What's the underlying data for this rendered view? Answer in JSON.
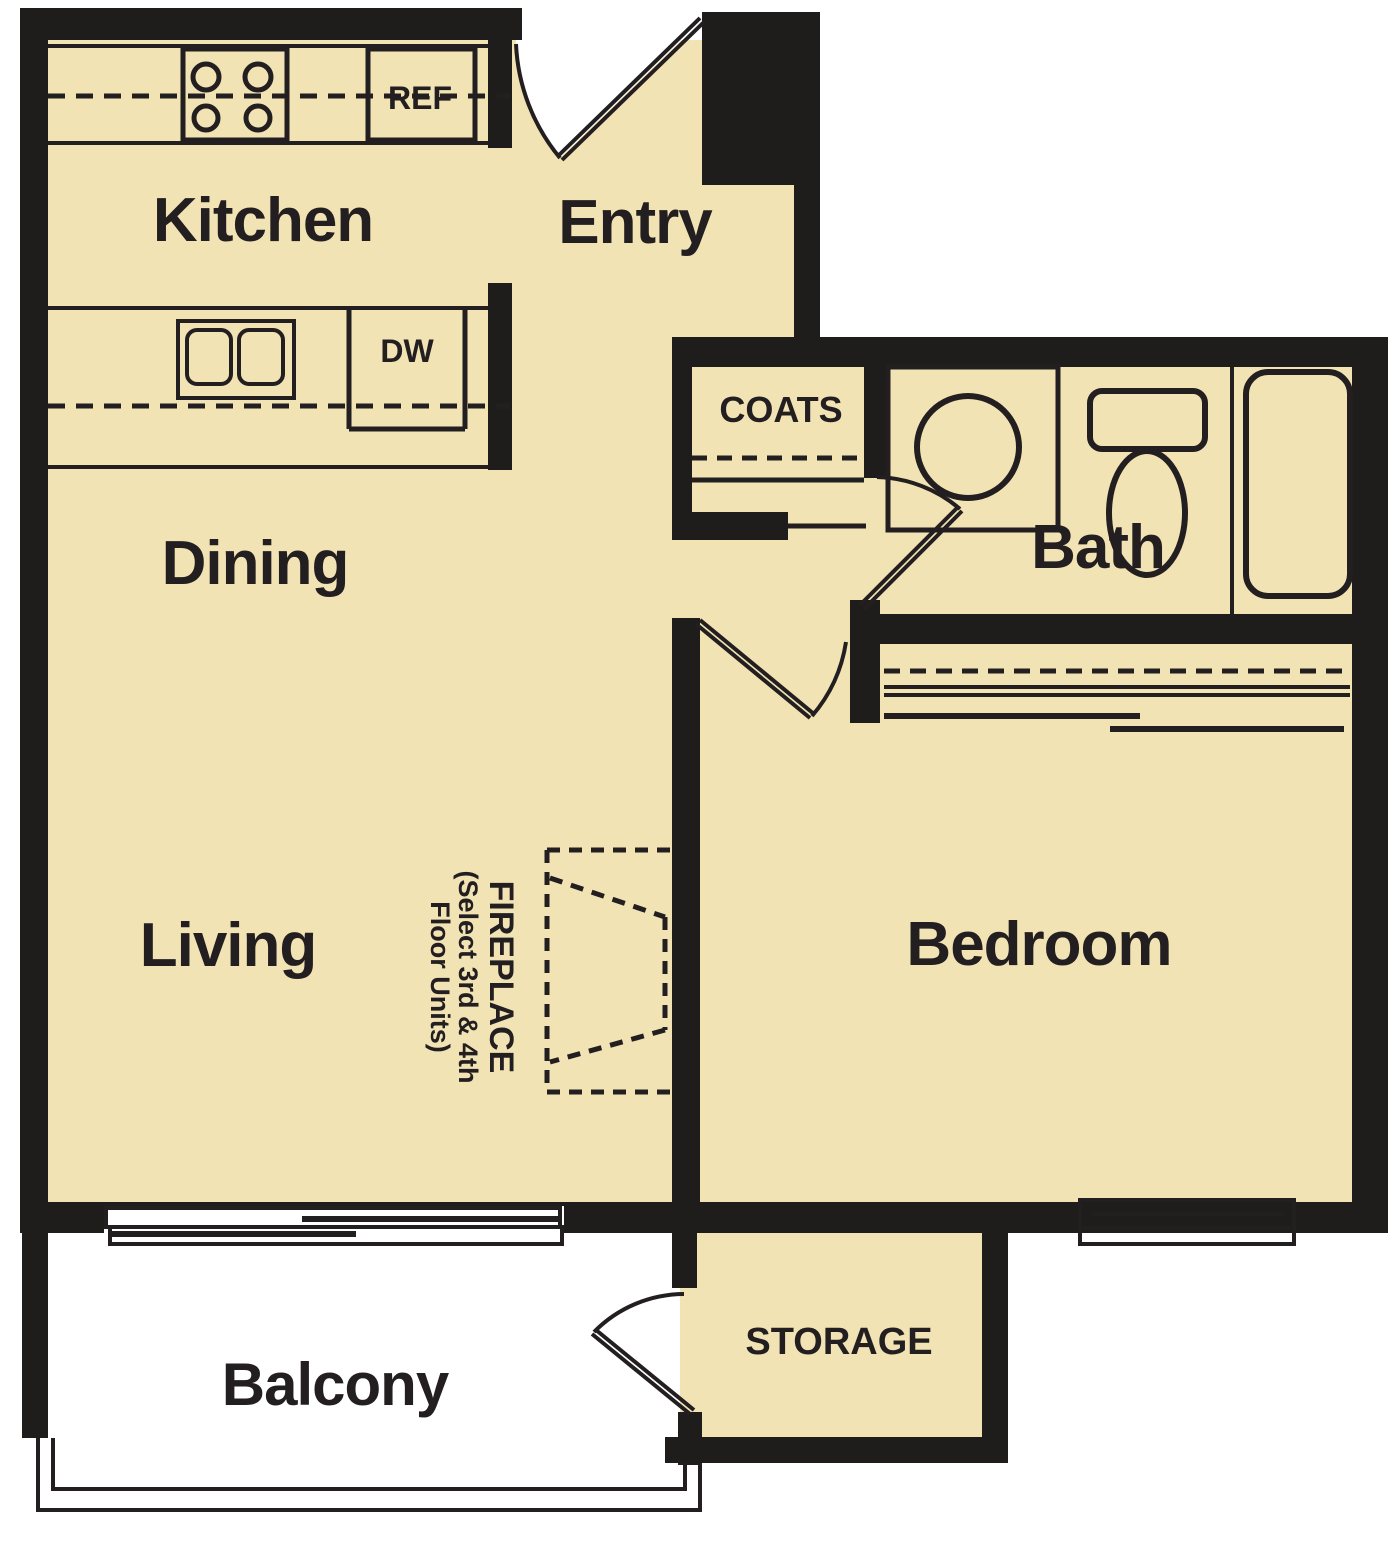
{
  "rooms": {
    "kitchen": "Kitchen",
    "entry": "Entry",
    "dining": "Dining",
    "living": "Living",
    "bath": "Bath",
    "bedroom": "Bedroom",
    "balcony": "Balcony",
    "coats": "COATS",
    "storage": "STORAGE"
  },
  "appliances": {
    "refrigerator": "REF",
    "dishwasher": "DW"
  },
  "fireplace_note": {
    "line1": "FIREPLACE",
    "line2": "(Select 3rd & 4th",
    "line3": "Floor Units)"
  },
  "colors": {
    "floor": "#F2E3B5",
    "wall": "#1F1D1B",
    "line": "#231F20",
    "outside": "#FFFFFF"
  }
}
